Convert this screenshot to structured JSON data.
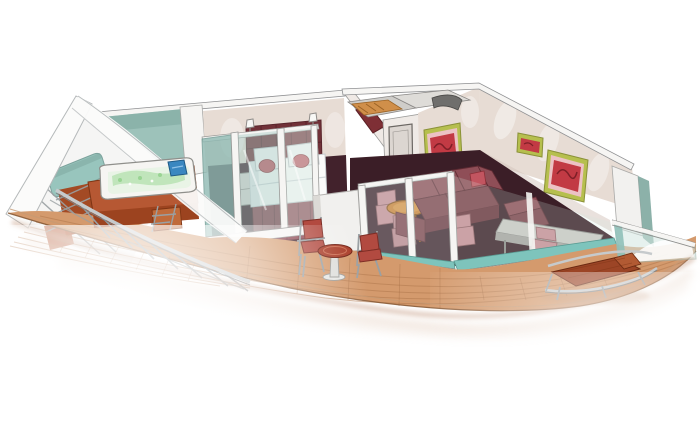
{
  "meta": {
    "title": "Watercolor cutaway illustration of a ship suite with wrap-around balcony",
    "style": "hand-drawn marker and watercolor, white background, no text"
  },
  "scene": {
    "rooms": [
      {
        "id": "hull",
        "label": "white ship hull wedge at forward tip"
      },
      {
        "id": "spa-terrace",
        "label": "whirlpool tub on rust-red platform against teal glass wall"
      },
      {
        "id": "bedroom",
        "label": "bedroom with double bed and tufted maroon headboard"
      },
      {
        "id": "entry-hall",
        "label": "entry hallway with door, mirror and open wardrobe ceiling cutaway"
      },
      {
        "id": "living-room",
        "label": "living room with maroon sectional sofa and artwork"
      },
      {
        "id": "dining-nook",
        "label": "round wooden table with pink chairs behind glass"
      },
      {
        "id": "balcony",
        "label": "curved teak balcony deck with railing and glass balustrade"
      }
    ],
    "furniture": [
      "double bed with white duvet, white pillows, two red bolster cushions",
      "maroon tufted headboard with two white wall sconces",
      "white nightstand",
      "maroon corner sectional sofa with red accent cushion",
      "maroon lounge chair",
      "round orange-wood pedestal dining table",
      "pink upholstered dining chairs",
      "long grey console desk with pink desk chair",
      "whirlpool tub with green water and blue towel",
      "metal step ladder to whirlpool platform",
      "two metal balcony chairs with brick-red cushions",
      "round red-top pedestal balcony table",
      "rust-red sling deck lounger",
      "three abstract red artworks in yellow-green frames",
      "dark red framed mirror on angled hallway wall",
      "grey cabin door"
    ],
    "colors_note": "palette below drives every fill via CSS variables"
  },
  "colors": {
    "page_bg": "#ffffff",
    "outline": "#8f9092",
    "hull_white": "#fbfbfa",
    "hull_face": "#f5f5f4",
    "hull_edge": "#b5b9ba",
    "wall_teal": "#9dc2ba",
    "wall_teal_dark": "#7fa8a0",
    "glass_teal": "#a9cdc6",
    "glass_teal_dark": "#8fbab3",
    "glass_pale": "#d3e6e1",
    "window_teal": "#8fc0b8",
    "wall_beige": "#e7dcd4",
    "wall_beige_shade": "#d3c4bc",
    "wall_white_top": "#f6f5f3",
    "headboard": "#713138",
    "headboard_line": "#58242b",
    "bed_white": "#fbfbfa",
    "bed_shadow": "#dde2e5",
    "bed_skirt": "#8c4650",
    "pillow_red": "#c25560",
    "carpet_dark": "#42222c",
    "carpet_dark2": "#3b1e27",
    "sofa": "#8f4e57",
    "sofa_mid": "#7d4049",
    "sofa_dark": "#6b333c",
    "sofa_line": "#5f2b33",
    "chair_pink": "#c98f96",
    "chair_pink2": "#bd848b",
    "chair_pink_dark": "#8f5a60",
    "table_wood": "#cf8030",
    "table_wood_light": "#e09a48",
    "table_wood_dark": "#8a4f17",
    "desk_gray": "#ccc9c5",
    "desk_gray_dark": "#a8a4a0",
    "door_gray": "#dcd6d1",
    "door_line": "#6b6763",
    "closet_orange": "#d08f4a",
    "closet_line": "#9c6426",
    "counter_dark": "#6f6e6c",
    "art_frame": "#b6bf4e",
    "art_frame_dark": "#8a9138",
    "art_mat": "#ecc2c4",
    "art_red": "#c23a44",
    "art_red_dark": "#7e1f27",
    "mirror_maroon": "#7e2f35",
    "deck_wood": "#d49a6d",
    "deck_line": "#b1794e",
    "deck_seam": "#a06a42",
    "deck_edge": "#8a5c39",
    "deck_edge_light": "#c59a74",
    "platform_rust": "#b65833",
    "platform_rust_dark": "#9c431f",
    "platform_step": "#c06a3a",
    "tip_rust": "#a34a24",
    "tub_white": "#f6f5f2",
    "tub_water": "#e9f4e6",
    "tub_water_green": "#b9e2b3",
    "tub_dots": "#8fcf8a",
    "towel_blue": "#3a87c0",
    "towel_blue_dark": "#205a85",
    "metal": "#9aa0a3",
    "metal_light": "#c6cacc",
    "metal_dark": "#7c8184",
    "balcony_chair_red": "#b24a40",
    "balcony_chair_dark": "#7e2d25",
    "balcony_table_red": "#a93b27",
    "balcony_table_ring": "#d57a5e",
    "lounger_rust": "#9c4526",
    "lounger_rust_light": "#b25a33",
    "lounger_dark": "#6b2a12",
    "threshold_teal": "#7ec4bc",
    "threshold_teal_dark": "#5a9b93",
    "shadow_warm": "#c9a189",
    "shadow_warm_light": "#dcbca6"
  }
}
